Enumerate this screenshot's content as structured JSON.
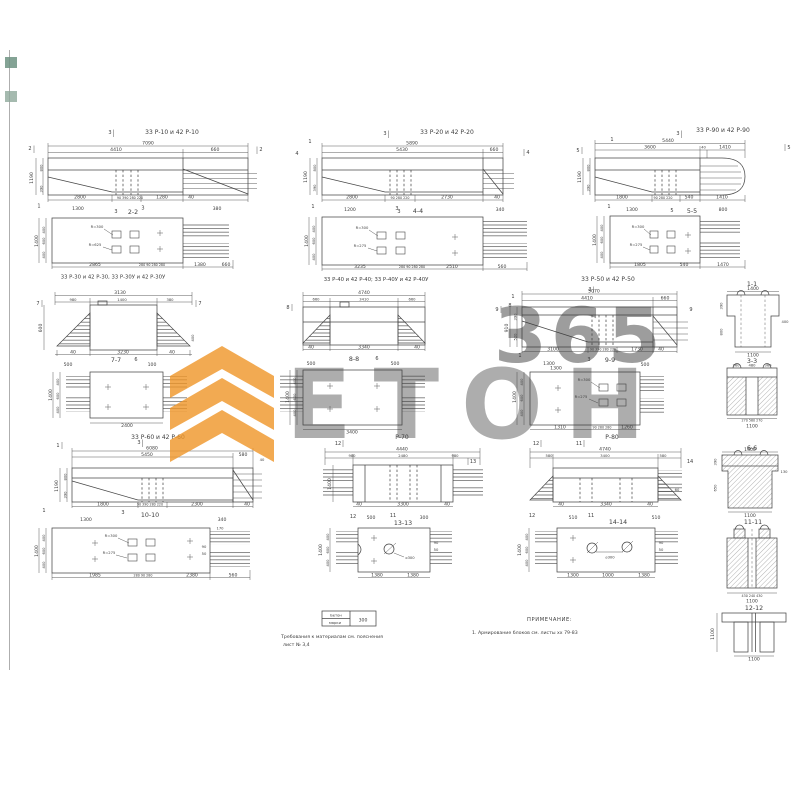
{
  "watermark": {
    "brand": "ЕТОН",
    "digits": "365",
    "accent": "#ef9527",
    "pale": "#f6b978"
  },
  "table": {
    "c1a": "Бетон",
    "c1b": "марки",
    "value": "300"
  },
  "notes": {
    "req1": "Требования к материалам см. пояснения",
    "req2": "лист № 3,4",
    "head": "ПРИМЕЧАНИЕ:",
    "item1": "1. Армирование блоков см. листы хх 79-83"
  },
  "d": {
    "r10": {
      "title": "33 Р-10 и 42 Р-10",
      "t1": "7090",
      "t2": "4410",
      "t3": "660",
      "h": "1190",
      "h1": "800",
      "h2": "390",
      "b1": "2800",
      "b2": "90 390 280 220",
      "b3": "1280",
      "b4": "40",
      "m1": "2",
      "m2": "3",
      "m3": "2",
      "m4": "1",
      "m5": "3"
    },
    "p22": {
      "sec": "2-2",
      "m": "3",
      "t1": "1300",
      "t2": "380",
      "r1": "R=300",
      "r2": "R=625",
      "l1": "400",
      "l2": "600",
      "l3": "400",
      "l": "1400",
      "b1": "2865",
      "b2": "280 90 280 280",
      "b3": "1380",
      "b4": "660"
    },
    "r20": {
      "title": "33 Р-20 и 42 Р-20",
      "t1": "5890",
      "t2": "5430",
      "t3": "660",
      "h": "1190",
      "h1": "800",
      "h2": "390",
      "b1": "2800",
      "b2": "90 280 220",
      "b3": "2730",
      "b4": "40",
      "m1": "1",
      "m2": "4",
      "m3": "3",
      "m4": "4",
      "m5": "1",
      "m6": "3"
    },
    "p44": {
      "sec": "4-4",
      "m": "3",
      "t1": "1200",
      "t2": "340",
      "r1": "R=300",
      "r2": "R=275",
      "l1": "400",
      "l2": "600",
      "l3": "400",
      "l": "1400",
      "b1": "3235",
      "b2": "280 90 280 280",
      "b3": "2510",
      "b4": "560"
    },
    "r90": {
      "title": "33 Р-90 и 42 Р-90",
      "t1": "5440",
      "t2": "3600",
      "t3": "40",
      "t4": "1410",
      "h": "1190",
      "h1": "800",
      "h2": "390",
      "b1": "1800",
      "b2": "90 280 220",
      "b3": "540",
      "b4": "1410",
      "m1": "5",
      "m2": "1",
      "m3": "3",
      "m4": "5",
      "m5": "1",
      "m6": "5"
    },
    "p55": {
      "sec": "5-5",
      "t1": "1300",
      "t2": "800",
      "r1": "R=300",
      "r2": "R=275",
      "l1": "400",
      "l2": "600",
      "l3": "400",
      "l": "1400",
      "b1": "1805",
      "b2": "540",
      "b3": "1470"
    },
    "s11": {
      "sec": "1-1",
      "t1": "1400",
      "lt": "390",
      "lb": "800",
      "r1": "400",
      "b1": "1100"
    },
    "s33": {
      "sec": "3-3",
      "t1": "360",
      "t2": "480",
      "t3": "360",
      "b1": "270 560 270",
      "b2": "1100"
    },
    "b30": {
      "title": "33 Р-30 и 42 Р-30, 33 Р-30У и 42 Р-30У",
      "t0": "3130",
      "t1": "980",
      "t2": "1400",
      "t3": "380",
      "h": "600",
      "r1": "400",
      "b1": "40",
      "b2": "3230",
      "b3": "40",
      "m1": "7",
      "m2": "7",
      "m3": "6",
      "sec": "7-7",
      "s1": "500",
      "s2": "100"
    },
    "p77": {
      "l1": "400",
      "l2": "600",
      "l3": "400",
      "l": "1400",
      "b1": "2400"
    },
    "b40": {
      "title": "33 Р-40 и 42 Р-40; 33 Р-40У и 42 Р-40У",
      "t0": "4740",
      "t1": "660",
      "t2": "3410",
      "t3": "660",
      "b1": "40",
      "b2": "3340",
      "b3": "40",
      "m1": "8",
      "m2": "8",
      "m3": "6",
      "sec": "8-8",
      "s1": "500",
      "s2": "500"
    },
    "p88": {
      "l": "1400",
      "l1": "400",
      "l2": "600",
      "l3": "400",
      "b1": "3400"
    },
    "b50": {
      "title": "33 Р-50 и 42 Р-50",
      "t1": "5070",
      "t2": "4410",
      "t3": "660",
      "h": "910",
      "h1": "390",
      "h2": "520",
      "b1": "3100",
      "b2": "90 390 280 220",
      "b3": "1730",
      "b4": "40",
      "m1": "9",
      "m2": "1",
      "m3": "3",
      "m4": "9",
      "m5": "1",
      "m6": "3",
      "sec": "9-9",
      "s1": "1300",
      "s2": "500"
    },
    "p99": {
      "t1": "1300",
      "r1": "R=300",
      "r2": "R=275",
      "l": "1400",
      "l1": "400",
      "l2": "600",
      "l3": "400",
      "b1": "1310",
      "b2": "90 280 280",
      "b3": "1260"
    },
    "s66": {
      "sec": "6-6",
      "t1": "1400",
      "lt": "390",
      "lb": "650",
      "r1": "130",
      "b1": "1100"
    },
    "b60": {
      "title": "33 Р-60 и 42 Р-60",
      "t1": "6080",
      "t2": "5450",
      "t3": "580",
      "h": "1190",
      "h1": "800",
      "h2": "390",
      "b1": "1800",
      "b2": "90 390 280 220",
      "b3": "2300",
      "b4": "40",
      "m1": "1",
      "m2": "3",
      "m3": "40",
      "m4": "1",
      "m5": "3",
      "sec": "10-10",
      "s1": "1300",
      "s2": "340"
    },
    "p1010": {
      "r1": "R=300",
      "r2": "R=275",
      "l": "1400",
      "l1": "400",
      "l2": "600",
      "l3": "400",
      "b1": "1985",
      "b2": "280 90 280",
      "b3": "2380",
      "b4": "560",
      "n1": "170",
      "n2": "90",
      "n3": "50"
    },
    "b70": {
      "title": "Р-70",
      "t0": "4440",
      "t1": "980",
      "t2": "2480",
      "t3": "980",
      "h": "1400",
      "b1": "40",
      "b2": "3300",
      "b3": "40",
      "m1": "12",
      "m2": "13",
      "m3": "12",
      "m4": "11",
      "s1": "500",
      "s2": "300",
      "sec": "13-13"
    },
    "p1313": {
      "dia": "⌀300",
      "l": "1400",
      "l1": "400",
      "l2": "600",
      "l3": "400",
      "b1": "1380",
      "b2": "1380",
      "n1": "90",
      "n2": "50"
    },
    "b80": {
      "title": "Р-80",
      "t0": "4740",
      "t1": "580",
      "t2": "3400",
      "t3": "580",
      "r1": "60",
      "b1": "40",
      "b2": "3340",
      "b3": "40",
      "m1": "12",
      "m2": "11",
      "m3": "14",
      "m4": "12",
      "m5": "11",
      "s1": "510",
      "s2": "510",
      "sec": "14-14"
    },
    "p1414": {
      "dia": "⌀300",
      "l": "1400",
      "l1": "400",
      "l2": "600",
      "l3": "400",
      "b1": "1300",
      "b2": "1000",
      "b3": "1380",
      "n1": "90",
      "n2": "50"
    },
    "s1111": {
      "sec": "11-11",
      "b1": "430 240 430",
      "b2": "1100"
    },
    "s1212": {
      "sec": "12-12",
      "l1": "1100",
      "b1": "1100"
    }
  }
}
